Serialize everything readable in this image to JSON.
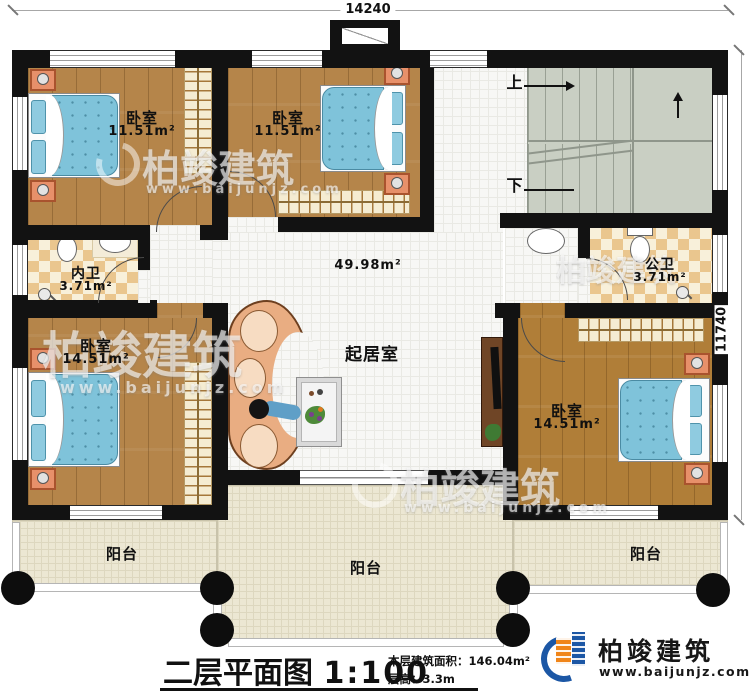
{
  "title": {
    "name": "二层平面图",
    "scale": "1:100"
  },
  "stats": {
    "area_label": "本层建筑面积：",
    "area_value": "146.04m²",
    "height_label": "层高：",
    "height_value": "3.3m"
  },
  "dims": {
    "top": "14240",
    "right": "11740"
  },
  "brand": {
    "name": "柏竣建筑",
    "site": "www.baijunjz.com"
  },
  "watermark": {
    "name": "柏竣建筑",
    "site": "www.baijunjz.com"
  },
  "rooms": {
    "bed1": {
      "name": "卧室",
      "area": "11.51m²"
    },
    "bed2": {
      "name": "卧室",
      "area": "11.51m²"
    },
    "bed3": {
      "name": "卧室",
      "area": "14.51m²"
    },
    "bed4": {
      "name": "卧室",
      "area": "14.51m²"
    },
    "inner_bath": {
      "name": "内卫",
      "area": "3.71m²"
    },
    "public_bath": {
      "name": "公卫",
      "area": "3.71m²"
    },
    "living": {
      "name": "起居室",
      "area": "49.98m²"
    },
    "balcony_left": {
      "name": "阳台"
    },
    "balcony_center": {
      "name": "阳台"
    },
    "balcony_right": {
      "name": "阳台"
    }
  },
  "stairs": {
    "up": "上",
    "down": "下"
  },
  "colors": {
    "wall": "#121212",
    "wood": "#b5854a",
    "wood_right": "#b07e38",
    "tile_white": "#f7f7f5",
    "tile_checker": "#eac68e",
    "balcony": "#ece7d3",
    "stairs": "#c9cfc3",
    "bed_blue": "#7fc3da",
    "nightstand_orange": "#e7906a",
    "brand_blue": "#1c57a5",
    "brand_orange": "#f08519"
  }
}
